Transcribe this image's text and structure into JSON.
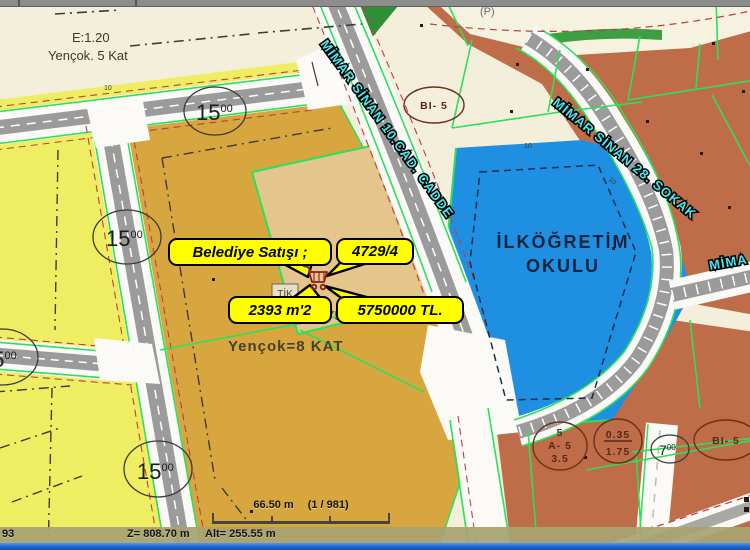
{
  "map": {
    "zone_labels": {
      "tl_line1": "E:1.20",
      "tl_line2": "Yençok. 5 Kat",
      "center_line1": "Yençok=8 KAT",
      "center_e": "E=1.75",
      "tik": "TİK",
      "school_line1": "İLKÖĞRETİM",
      "school_line2": "OKULU",
      "parking": "(P)"
    },
    "streets": {
      "cadde": "MİMAR SİNAN 10.CAD.  CADDE",
      "sokak": "MİMAR SİNAN 28.  SOKAK",
      "mima": "MİMA"
    },
    "callouts": {
      "sale": "Belediye Satışı ;",
      "parcel_no": "4729/4",
      "area": "2393 m'2",
      "price": "5750000 TL."
    },
    "width_circles": [
      {
        "main": "15",
        "sup": "00"
      },
      {
        "main": "15",
        "sup": "00"
      },
      {
        "main": "15",
        "sup": "00"
      },
      {
        "main": "15",
        "sup": "00"
      },
      {
        "main": "7",
        "sup": "00"
      }
    ],
    "zone_circles": {
      "bi5_top": "BI- 5",
      "bi5_bottom": "BI- 5",
      "a5_line1": "5",
      "a5_line2": "A- 5",
      "a5_line3": "3.5",
      "frac_top": "0.35",
      "frac_bottom": "1.75"
    },
    "ticks": [
      "10",
      "10",
      "10"
    ]
  },
  "scalebar": {
    "distance": "66.50 m",
    "ratio": "(1 / 981)"
  },
  "statusbar": {
    "left": "93",
    "z": "Z= 808.70 m",
    "alt": "Alt= 255.55 m"
  },
  "colors": {
    "parcel_yellow": "#efed62",
    "parcel_gold": "#d8a63e",
    "parcel_tan": "#e4c68c",
    "parcel_brown": "#bf6c48",
    "school_blue": "#1f8fe2",
    "line_green": "#2be05c",
    "road_gray": "#9b9b9b",
    "street_label_cyan": "#45e8f0",
    "callout_yellow": "#ffff00",
    "taskbar_blue": "#1a66d0"
  }
}
